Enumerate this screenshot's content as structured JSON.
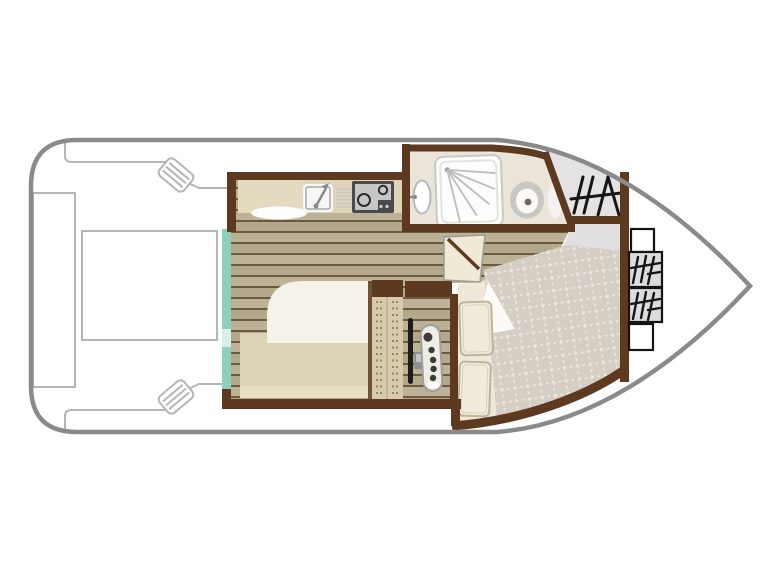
{
  "canvas": {
    "width": 768,
    "height": 576,
    "background": "#ffffff"
  },
  "colors": {
    "white": "#ffffff",
    "hull": "#8a8a8a",
    "deck_line": "#b5b5b5",
    "wall": "#5d3a1f",
    "wall_thin": "#6e5335",
    "floor_base": "#b3a88c",
    "floor_alt": "#bdb298",
    "floor_line": "#6b5a3e",
    "teal": "#8ed1ba",
    "teal_pale": "#d9efe6",
    "counter": "#ded4b8",
    "counter_light": "#e3dac0",
    "rug": "#fdfdfd",
    "rug_edge": "#e0e0e0",
    "sink": "#f6f6f6",
    "sink_edge": "#a8a8a8",
    "faucet": "#8a8a8a",
    "drainer": "#c9c9c9",
    "appliance_dark": "#4a4a4a",
    "appliance_panel": "#c6c6c6",
    "burner_ring": "#2d2d2d",
    "knob_dot": "#cfcfcf",
    "bathroom_floor": "#eae4d9",
    "shower": "#fdfdfc",
    "shower_edge": "#c9c9c9",
    "shower_inner": "#e3e3e3",
    "spray": "#bdbdbd",
    "spray_dot": "#9a9a9a",
    "basin_edge": "#b9b9b9",
    "fixture_gray": "#c9c7c3",
    "bowl_white": "#fbfaf8",
    "drain_dot": "#6f675d",
    "cistern": "#f3f2ef",
    "cistern_edge": "#dddbd6",
    "deck_gray": "#e4e2e2",
    "vestibule": "#e1dfdf",
    "glyph": "#161616",
    "bed_cream": "#efe8d8",
    "duvet": "#f5f2ea",
    "mattress": "#dcd2b5",
    "mattress_band": "#e7dfc3",
    "quilt": "#d4cec5",
    "quilt_grid": "#eae7e0",
    "pillow": "#f1ebdb",
    "pillow_edge": "#bdb49c",
    "pillow_inner": "#d8d0ba",
    "sheet": "#fbfaf6",
    "sheet_edge": "#e2ded2",
    "door": "#efe9d6",
    "door_edge": "#9c9c9c",
    "wardrobe": "#d8cbab",
    "wardrobe_dot": "#7a6a4a",
    "wardrobe_divider": "#c3b493",
    "wheel": "#1c1c1c",
    "gear": "#8f8f8f",
    "gear_light": "#c4c4c4",
    "console": "#efece6",
    "console_edge": "#9e9e9e",
    "button": "#3b3b3b",
    "box_fill": "#dcdcdc",
    "box_edge": "#141414"
  }
}
